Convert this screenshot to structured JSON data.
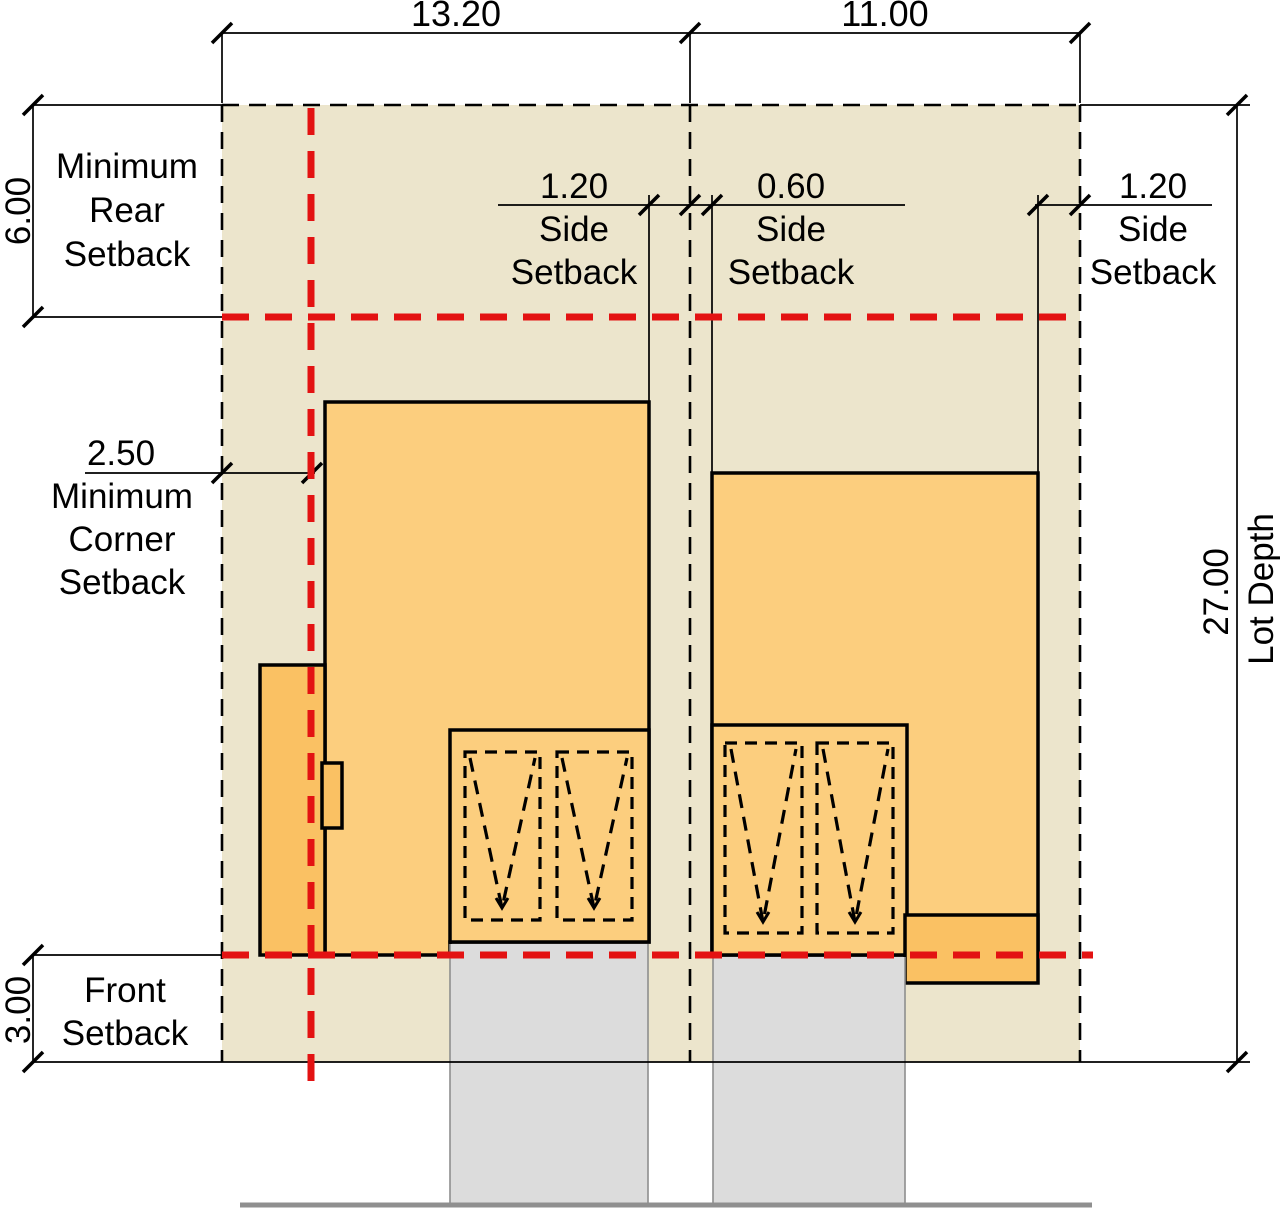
{
  "diagram": {
    "type": "lot-setback-site-plan",
    "lots": {
      "left_width": "13.20",
      "right_width": "11.00",
      "depth_value": "27.00",
      "depth_label": "Lot Depth"
    },
    "setbacks": {
      "rear": {
        "value": "6.00",
        "lines": [
          "Minimum",
          "Rear",
          "Setback"
        ]
      },
      "corner": {
        "value": "2.50",
        "lines": [
          "Minimum",
          "Corner",
          "Setback"
        ]
      },
      "side_left": {
        "value": "1.20",
        "lines": [
          "Side",
          "Setback"
        ]
      },
      "side_middle": {
        "value": "0.60",
        "lines": [
          "Side",
          "Setback"
        ]
      },
      "side_right": {
        "value": "1.20",
        "lines": [
          "Side",
          "Setback"
        ]
      },
      "front": {
        "value": "3.00",
        "lines": [
          "Front",
          "Setback"
        ]
      }
    },
    "colors": {
      "lot_fill": "#ECE5CC",
      "building_fill": "#FCCE7E",
      "building_accent_fill": "#FAC163",
      "driveway_fill": "#DCDCDC",
      "setback_line_red": "#E31212",
      "street_line_gray": "#8F8F8F",
      "outline_black": "#000000"
    }
  }
}
